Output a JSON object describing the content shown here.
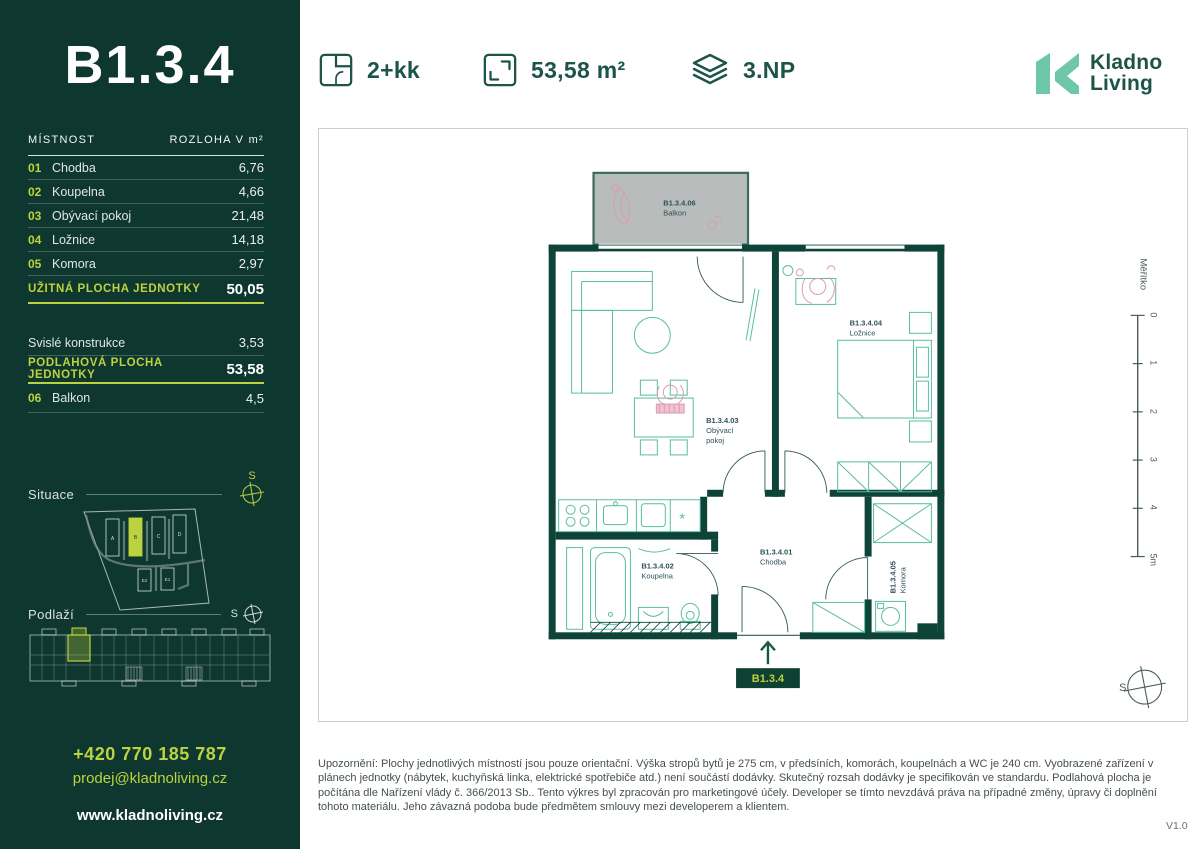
{
  "sidebar": {
    "unit_title": "B1.3.4",
    "table": {
      "header": {
        "room": "MÍSTNOST",
        "area": "ROZLOHA V m²"
      },
      "rows": [
        {
          "num": "01",
          "name": "Chodba",
          "value": "6,76"
        },
        {
          "num": "02",
          "name": "Koupelna",
          "value": "4,66"
        },
        {
          "num": "03",
          "name": "Obývací pokoj",
          "value": "21,48"
        },
        {
          "num": "04",
          "name": "Ložnice",
          "value": "14,18"
        },
        {
          "num": "05",
          "name": "Komora",
          "value": "2,97"
        }
      ],
      "usable": {
        "label": "UŽITNÁ PLOCHA JEDNOTKY",
        "value": "50,05"
      },
      "vertical": {
        "label": "Svislé konstrukce",
        "value": "3,53"
      },
      "floor_total": {
        "label": "PODLAHOVÁ PLOCHA JEDNOTKY",
        "value": "53,58"
      },
      "balcony_row": {
        "num": "06",
        "name": "Balkon",
        "value": "4,5"
      }
    },
    "situace_label": "Situace",
    "podlazi_label": "Podlaží",
    "compass_letter": "S",
    "site_buildings": [
      "A",
      "B",
      "C",
      "D",
      "E2",
      "E1"
    ],
    "contact": {
      "phone": "+420 770 185 787",
      "email": "prodej@kladnoliving.cz",
      "web": "www.kladnoliving.cz"
    }
  },
  "header": {
    "layout": "2+kk",
    "area": "53,58 m²",
    "floor": "3.NP",
    "logo_line1": "Kladno",
    "logo_line2": "Living"
  },
  "plan": {
    "rooms": {
      "balcony": {
        "id": "B1.3.4.06",
        "name": "Balkon"
      },
      "bedroom": {
        "id": "B1.3.4.04",
        "name": "Ložnice"
      },
      "living": {
        "id": "B1.3.4.03",
        "name_l1": "Obývací",
        "name_l2": "pokoj"
      },
      "hall": {
        "id": "B1.3.4.01",
        "name": "Chodba"
      },
      "bath": {
        "id": "B1.3.4.02",
        "name": "Koupelna"
      },
      "storage": {
        "id": "B1.3.4.05",
        "name": "Komora"
      }
    },
    "entrance_badge": "B1.3.4",
    "fridge_marker": "*",
    "scale": {
      "label": "Měřítko",
      "ticks": [
        "0",
        "1",
        "2",
        "3",
        "4",
        "5m"
      ]
    },
    "north_letter": "S"
  },
  "footer": {
    "disclaimer": "Upozornění: Plochy jednotlivých místností jsou pouze orientační. Výška stropů bytů je 275 cm, v předsíních, komorách, koupelnách a WC je 240 cm. Vyobrazené zařízení v plánech jednotky (nábytek, kuchyňská linka, elektrické spotřebiče atd.) není součástí dodávky. Skutečný rozsah dodávky je specifikován ve standardu. Podlahová plocha je počítána dle Nařízení vlády č. 366/2013 Sb.. Tento výkres byl zpracován pro marketingové účely. Developer se tímto nevzdává práva na případné změny, úpravy či doplnění tohoto materiálu. Jeho závazná podoba bude předmětem smlouvy mezi developerem a klientem.",
    "version": "V1.0"
  },
  "colors": {
    "sidebar_bg": "#0d372f",
    "lime": "#bdd23f",
    "header_green": "#1c5447",
    "logo_mint": "#6ec6ab",
    "wall": "#0e4338",
    "furniture": "#58bda0",
    "balcony_fill": "#b8bdbb",
    "label": "#2d4f59"
  }
}
